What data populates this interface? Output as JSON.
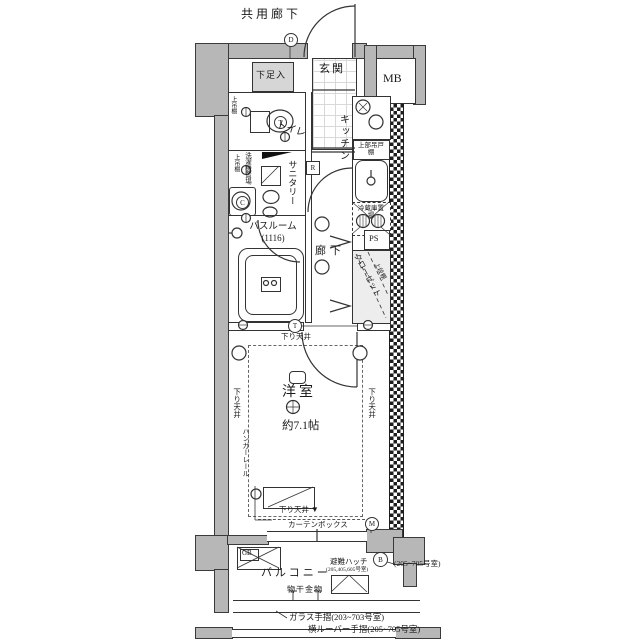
{
  "header": {
    "common_corridor": "共用廊下"
  },
  "rooms": {
    "genkan": "玄関",
    "shoe_box": "下足入",
    "meter_box": "MB",
    "toilet": "トイレ",
    "kitchen": "キッチン",
    "sanitary": "サニタリー",
    "bathroom": "バスルーム",
    "bathroom_size": "(1116)",
    "hallway": "廊下",
    "pipe_space": "PS",
    "closet": "クローゼット",
    "closet_shelf": "上段棚",
    "western_room": "洋室",
    "western_room_size": "約7.1帖",
    "balcony": "バルコニー"
  },
  "fixtures": {
    "upper_shelf": "上吊棚",
    "washer_place": "洗濯機置場",
    "kitchen_upper_cabinet": "上部吊戸棚",
    "fridge_place": "冷蔵庫置場",
    "hanger_rail": "ハンガーレール",
    "curtain_box": "カーテンボックス",
    "laundry_hardware": "物干金物",
    "evacuation_hatch": "避難ハッチ",
    "evacuation_hatch_rooms": "(205,405,605号室)",
    "gas_box": "GB"
  },
  "ceiling_notes": {
    "top": "下り天井",
    "left": "下り天井",
    "right": "下り天井",
    "bottom": "下り天井",
    "bottom_arrow": "▼"
  },
  "symbols": {
    "d": "D",
    "m": "M",
    "b": "B",
    "r": "R",
    "t": "T",
    "c": "C"
  },
  "footer_notes": {
    "right_rooms": "(205~705号室)",
    "glass_handrail": "ガラス手摺(203~703号室)",
    "louver_handrail": "横ルーバー手摺(205~705号室)"
  }
}
